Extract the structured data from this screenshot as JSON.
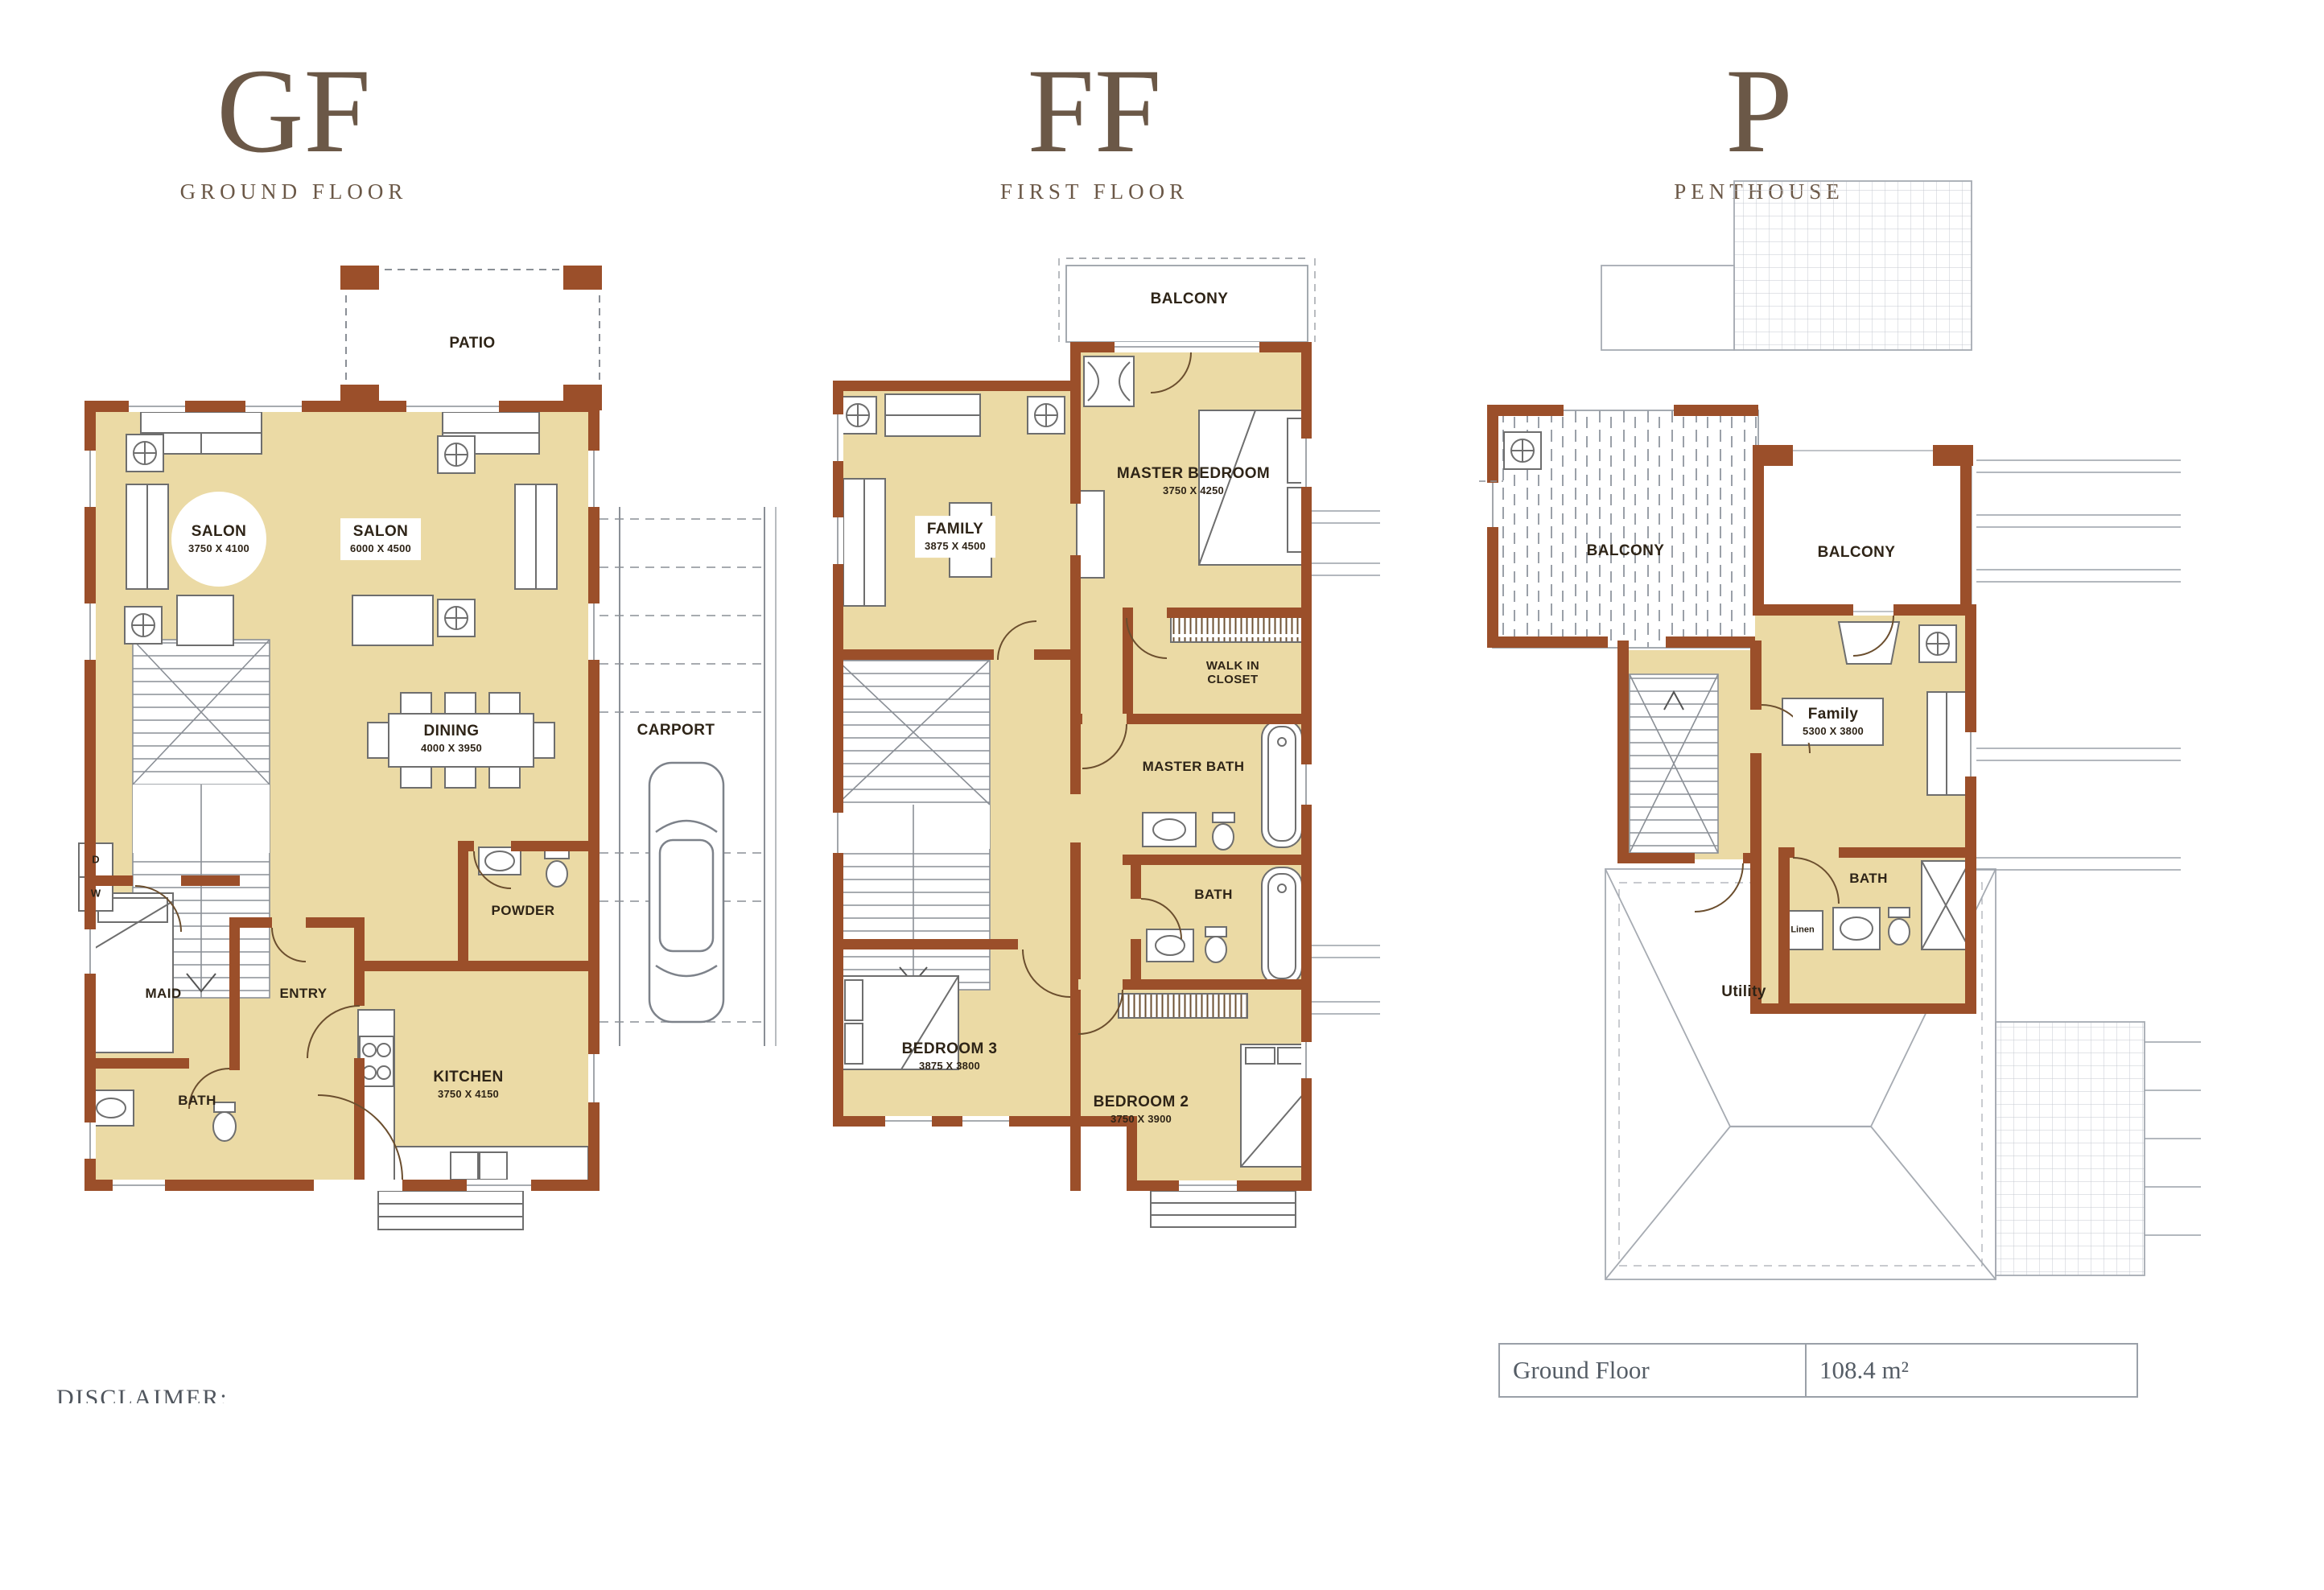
{
  "headers": [
    {
      "abbr": "GF",
      "caption": "GROUND FLOOR"
    },
    {
      "abbr": "FF",
      "caption": "FIRST FLOOR"
    },
    {
      "abbr": "P",
      "caption": "PENTHOUSE"
    }
  ],
  "gf": {
    "patio": "PATIO",
    "salon_left": {
      "name": "SALON",
      "dim": "3750 X 4100"
    },
    "salon_right": {
      "name": "SALON",
      "dim": "6000 X 4500"
    },
    "dining": {
      "name": "DINING",
      "dim": "4000 X 3950"
    },
    "carport": "CARPORT",
    "powder": "POWDER",
    "maid": "MAID",
    "entry": "ENTRY",
    "bath": "BATH",
    "kitchen": {
      "name": "KITCHEN",
      "dim": "3750 X 4150"
    },
    "dryer": "D",
    "washer": "W"
  },
  "ff": {
    "balcony": "BALCONY",
    "master_bedroom": {
      "name": "MASTER BEDROOM",
      "dim": "3750 X 4250"
    },
    "family": {
      "name": "FAMILY",
      "dim": "3875 X 4500"
    },
    "walk_in_closet": "WALK IN CLOSET",
    "master_bath": "MASTER BATH",
    "bath": "BATH",
    "bedroom_3": {
      "name": "BEDROOM 3",
      "dim": "3875 X 3800"
    },
    "bedroom_2": {
      "name": "BEDROOM 2",
      "dim": "3750 X 3900"
    }
  },
  "p": {
    "balcony_left": "BALCONY",
    "balcony_right": "BALCONY",
    "family": {
      "name": "Family",
      "dim": "5300 X 3800"
    },
    "bath": "BATH",
    "linen": "Linen",
    "utility": "Utility"
  },
  "footer": {
    "disclaimer": "DISCLAIMER:",
    "table": {
      "label": "Ground Floor",
      "value": "108.4 m²"
    }
  }
}
